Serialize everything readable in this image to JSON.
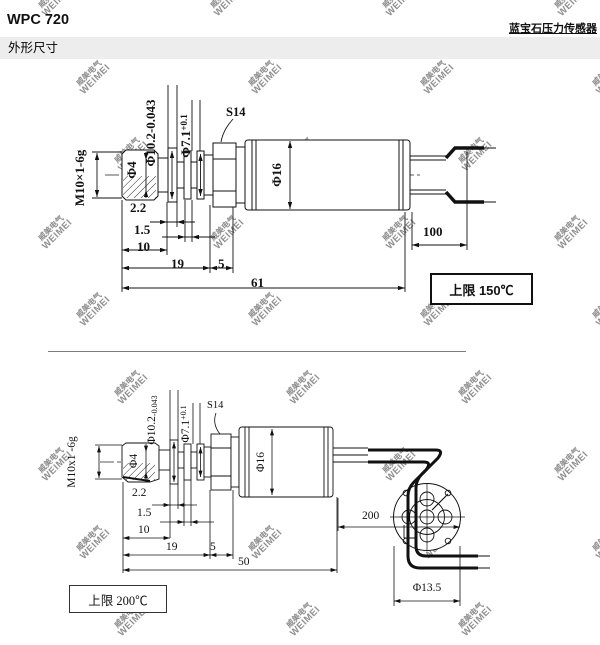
{
  "header": {
    "model": "WPC 720",
    "product": "蓝宝石压力传感器",
    "section": "外形尺寸"
  },
  "watermark": {
    "line1": "威美电气",
    "line2": "WEIMEI",
    "color": "#8f8f8f"
  },
  "drawing1": {
    "thread_label": "M10×1-6g",
    "phi4": "Φ4",
    "phi102": "Φ10.2-0.043",
    "phi71_base": "Φ7.1",
    "phi71_tol": "+0.1",
    "hex_label": "S14",
    "body_dia": "Φ16",
    "dim_2_2": "2.2",
    "dim_1_5": "1.5",
    "dim_10": "10",
    "dim_19": "19",
    "dim_5": "5",
    "dim_61": "61",
    "wire_len": "100",
    "temp_note": "上限 150℃"
  },
  "drawing2": {
    "thread_label": "M10x1 -6g",
    "phi4": "Φ4",
    "phi102_base": "Φ10.2",
    "phi102_tol": "-0.043",
    "phi71_base": "Φ7.1",
    "phi71_tol": "+0.1",
    "hex_label": "S14",
    "body_dia": "Φ16",
    "dim_2_2": "2.2",
    "dim_1_5": "1.5",
    "dim_10": "10",
    "dim_19": "19",
    "dim_5": "5",
    "dim_50": "50",
    "wire_len": "200",
    "conn_dia": "Φ13.5",
    "temp_note": "上限 200℃"
  }
}
